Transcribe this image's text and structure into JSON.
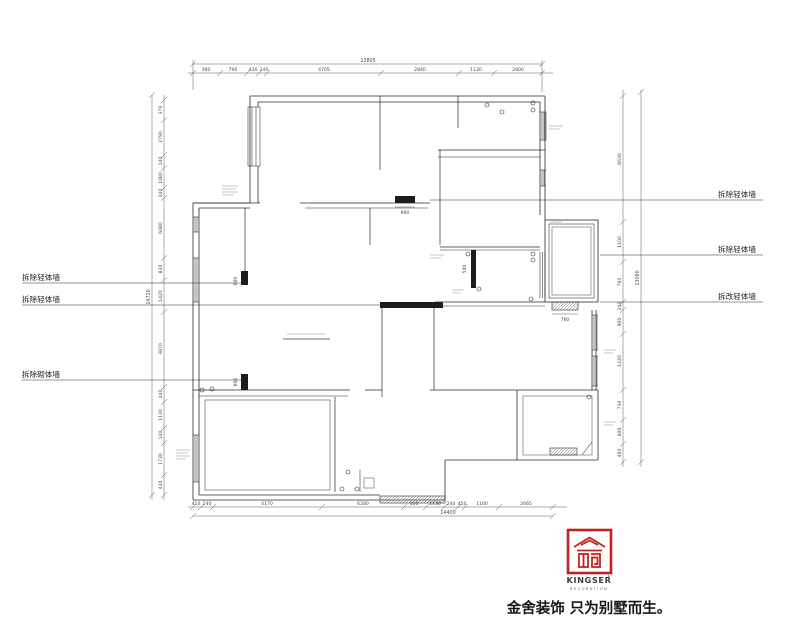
{
  "drawing": {
    "left_labels": [
      "拆除轻体墙",
      "拆除轻体墙",
      "拆除砌体墙"
    ],
    "right_labels": [
      "拆除轻体墙",
      "拆除轻体墙",
      "拆改轻体墙"
    ]
  },
  "dimensions": {
    "top": {
      "total": "13805",
      "segments": [
        "390",
        "790",
        "430",
        "240",
        "4705",
        "2840",
        "1130",
        "2800"
      ]
    },
    "bottom": {
      "total": "14400",
      "segments": [
        "410",
        "240",
        "4170",
        "6280",
        "110",
        "1130",
        "240",
        "450",
        "1100",
        "2665"
      ]
    },
    "left": {
      "total": "14720",
      "segments": [
        "370",
        "2790",
        "140",
        "1080",
        "240",
        "6080",
        "830",
        "1420",
        "3870",
        "440",
        "1130",
        "140",
        "1730",
        "430"
      ]
    },
    "right": {
      "total": "13060",
      "segments": [
        "8630",
        "1100",
        "760",
        "240",
        "900",
        "1420",
        "730",
        "600",
        "460"
      ]
    },
    "interior": {
      "d900": "900",
      "d760": "760",
      "d500": "500",
      "d600a": "600",
      "d600b": "600"
    }
  },
  "logo": {
    "brand": "KINGSER",
    "registered": "®",
    "subtitle": "DECORATION",
    "slogan": "金舍装饰 只为别墅而生。"
  },
  "colors": {
    "wall": "#2b2b2b",
    "dim": "#5a5a5a",
    "accent": "#c4201d"
  }
}
